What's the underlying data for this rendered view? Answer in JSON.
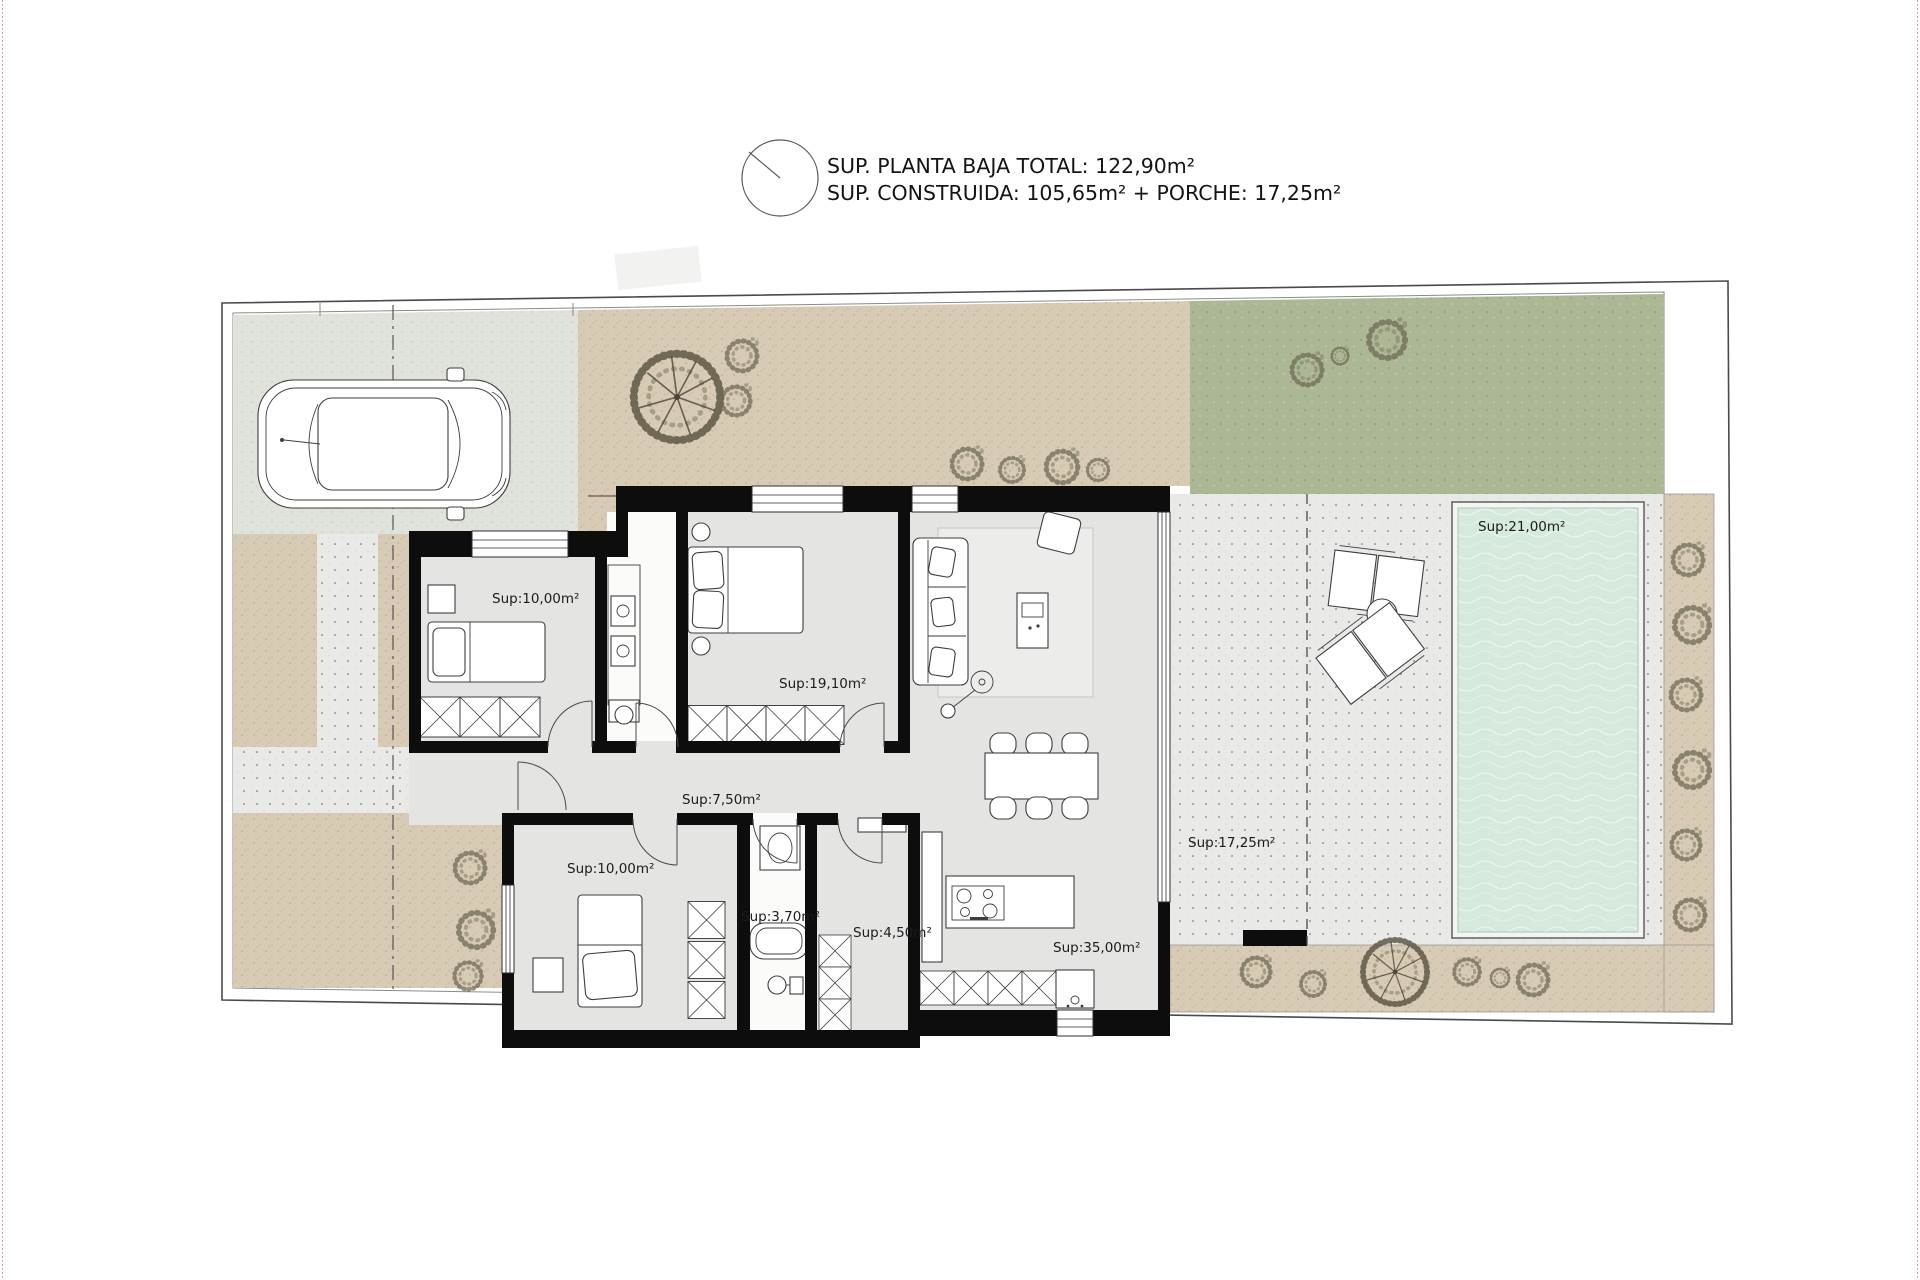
{
  "title": {
    "line1": "SUP. PLANTA BAJA TOTAL: 122,90m²",
    "line2": "SUP. CONSTRUIDA: 105,65m² + PORCHE: 17,25m²"
  },
  "rooms": [
    {
      "id": "bedroom-1",
      "label": "Sup:10,00m²"
    },
    {
      "id": "master-bedroom",
      "label": "Sup:19,10m²"
    },
    {
      "id": "hallway",
      "label": "Sup:7,50m²"
    },
    {
      "id": "bedroom-2",
      "label": "Sup:10,00m²"
    },
    {
      "id": "bathroom-2",
      "label": "Sup:3,70m²"
    },
    {
      "id": "laundry",
      "label": "Sup:4,50m²"
    },
    {
      "id": "living-kitchen",
      "label": "Sup:35,00m²"
    },
    {
      "id": "porch",
      "label": "Sup:17,25m²"
    },
    {
      "id": "pool",
      "label": "Sup:21,00m²"
    }
  ],
  "icons": {
    "north_indicator": "north-indicator-icon"
  },
  "colors": {
    "wall": "#0d0d0d",
    "floor": "#e4e4e2",
    "bath_floor": "#fbfbfa",
    "beige": "#d8cbb5",
    "lawn": "#abb795",
    "concrete": "#e0e3db",
    "terrace": "#e9e9e7",
    "pool_water": "#d5e9dd",
    "boundary": "#4a4a4a",
    "label": "#1c1c1c",
    "page_edge": "#d9a0a0"
  }
}
